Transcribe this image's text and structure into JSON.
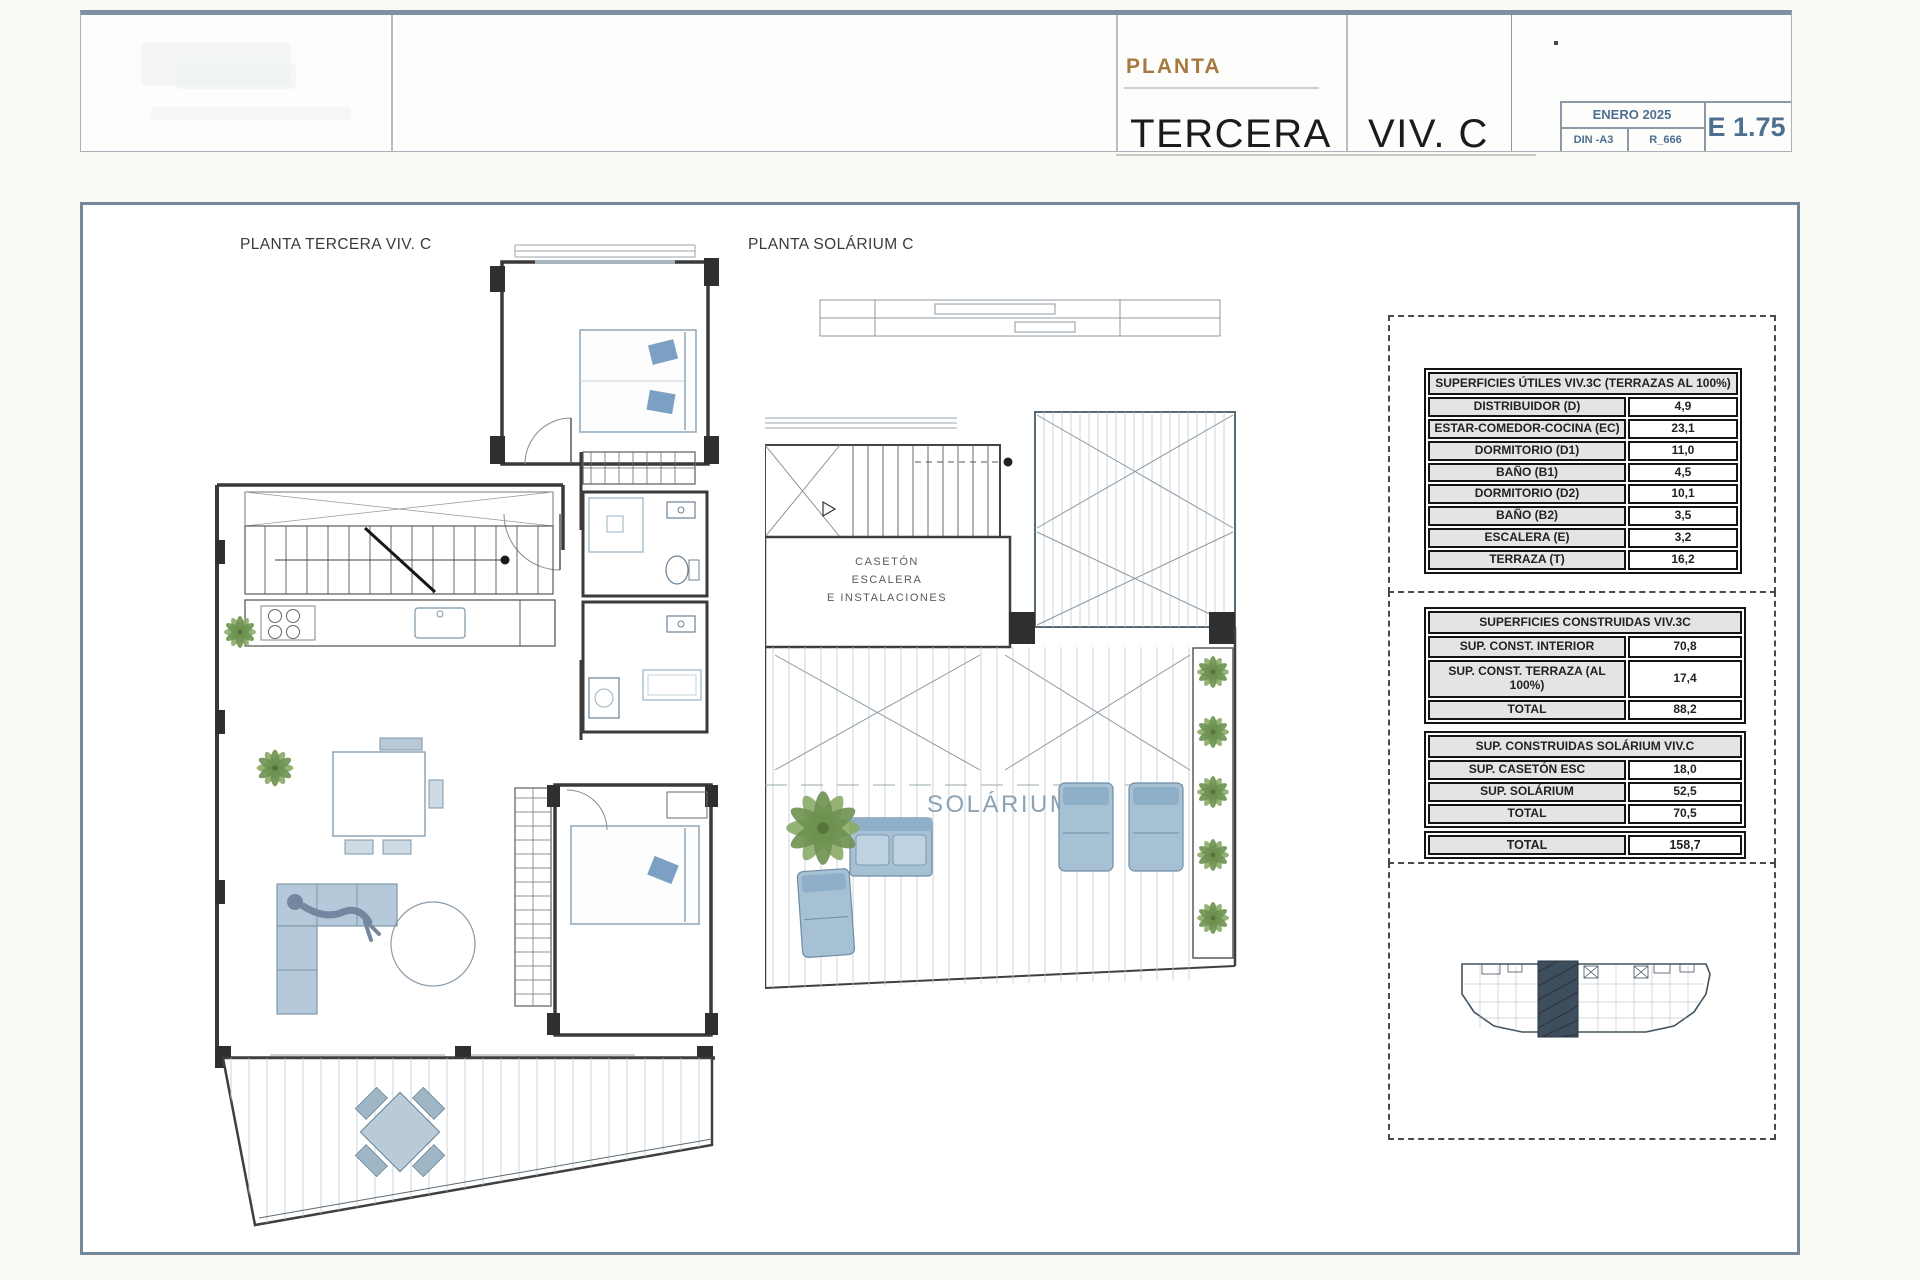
{
  "title_block": {
    "series_label": "PLANTA",
    "floor_name": "TERCERA",
    "unit_name": "VIV. C",
    "date": "ENERO 2025",
    "paper_size": "DIN -A3",
    "reference": "R_666",
    "scale": "E 1.75"
  },
  "plan_left": {
    "title": "PLANTA TERCERA VIV. C"
  },
  "plan_right": {
    "title": "PLANTA SOLÁRIUM C",
    "caseton_line1": "CASETÓN",
    "caseton_line2": "ESCALERA",
    "caseton_line3": "E INSTALACIONES",
    "solarium_label": "SOLÁRIUM C"
  },
  "surface_tables": {
    "utiles": {
      "header": "SUPERFICIES ÚTILES VIV.3C (TERRAZAS AL 100%)",
      "rows": [
        {
          "label": "DISTRIBUIDOR (D)",
          "value": "4,9"
        },
        {
          "label": "ESTAR-COMEDOR-COCINA (EC)",
          "value": "23,1"
        },
        {
          "label": "DORMITORIO (D1)",
          "value": "11,0"
        },
        {
          "label": "BAÑO (B1)",
          "value": "4,5"
        },
        {
          "label": "DORMITORIO (D2)",
          "value": "10,1"
        },
        {
          "label": "BAÑO (B2)",
          "value": "3,5"
        },
        {
          "label": "ESCALERA (E)",
          "value": "3,2"
        },
        {
          "label": "TERRAZA (T)",
          "value": "16,2"
        }
      ]
    },
    "construidas": {
      "header": "SUPERFICIES CONSTRUIDAS VIV.3C",
      "rows": [
        {
          "label": "SUP. CONST. INTERIOR",
          "value": "70,8"
        },
        {
          "label": "SUP. CONST. TERRAZA   (AL 100%)",
          "value": "17,4"
        },
        {
          "label": "TOTAL",
          "value": "88,2"
        }
      ]
    },
    "solarium": {
      "header": "SUP. CONSTRUIDAS SOLÁRIUM VIV.C",
      "rows": [
        {
          "label": "SUP. CASETÓN ESC",
          "value": "18,0"
        },
        {
          "label": "SUP. SOLÁRIUM",
          "value": "52,5"
        },
        {
          "label": "TOTAL",
          "value": "70,5"
        }
      ]
    },
    "grand_total": {
      "label": "TOTAL",
      "value": "158,7"
    }
  },
  "colors": {
    "accent_brown": "#a5793f",
    "steel_blue": "#4e7090",
    "furniture_blue": "#a6c0d4",
    "plant_green": "#8aab68",
    "wall_dark": "#3a3a3a",
    "frame_border": "#74889a"
  }
}
